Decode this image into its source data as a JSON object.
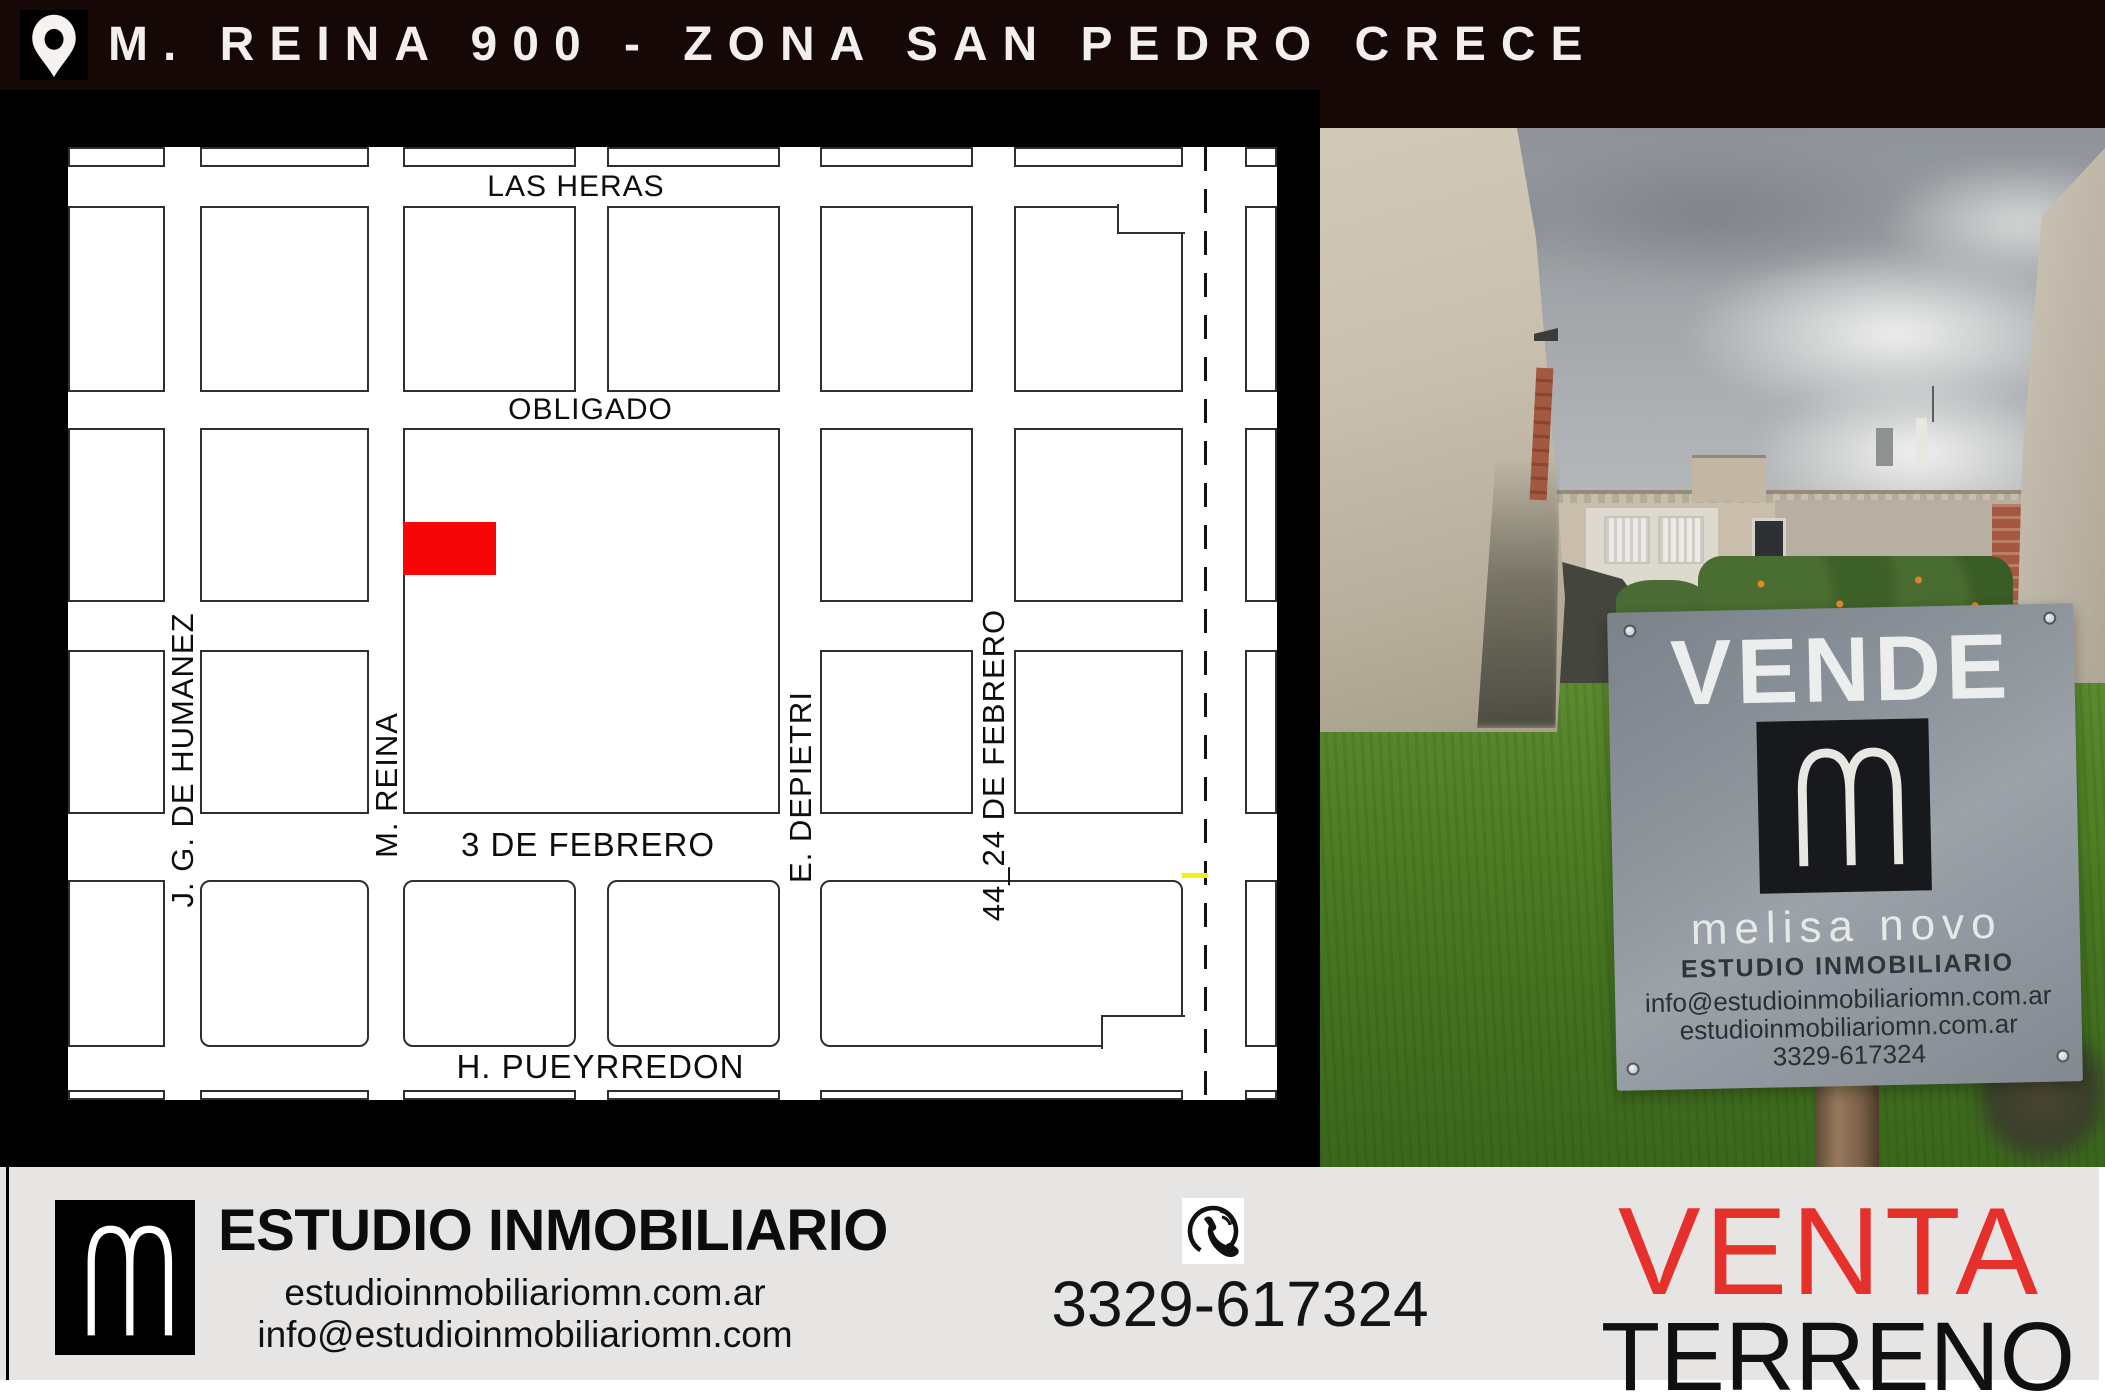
{
  "header": {
    "title": "M. REINA 900 - ZONA SAN PEDRO CRECE"
  },
  "map": {
    "horizontal_streets": [
      "LAS HERAS",
      "OBLIGADO",
      "3 DE FEBRERO",
      "H. PUEYRREDON"
    ],
    "vertical_streets": [
      "J. G. DE HUMANEZ",
      "M. REINA",
      "E. DEPIETRI",
      "44_24 DE FEBRERO"
    ],
    "marker_color": "#f60606"
  },
  "sign": {
    "headline": "VENDE",
    "brand": "melisa novo",
    "subtitle": "ESTUDIO INMOBILIARIO",
    "email": "info@estudioinmobiliariomn.com.ar",
    "website": "estudioinmobiliariomn.com.ar",
    "phone": "3329-617324"
  },
  "footer": {
    "company": "ESTUDIO INMOBILIARIO",
    "website": "estudioinmobiliariomn.com.ar",
    "email": "info@estudioinmobiliariomn.com",
    "phone": "3329-617324",
    "operation": "VENTA",
    "property_type": "TERRENO",
    "accent_color": "#e5302c"
  }
}
